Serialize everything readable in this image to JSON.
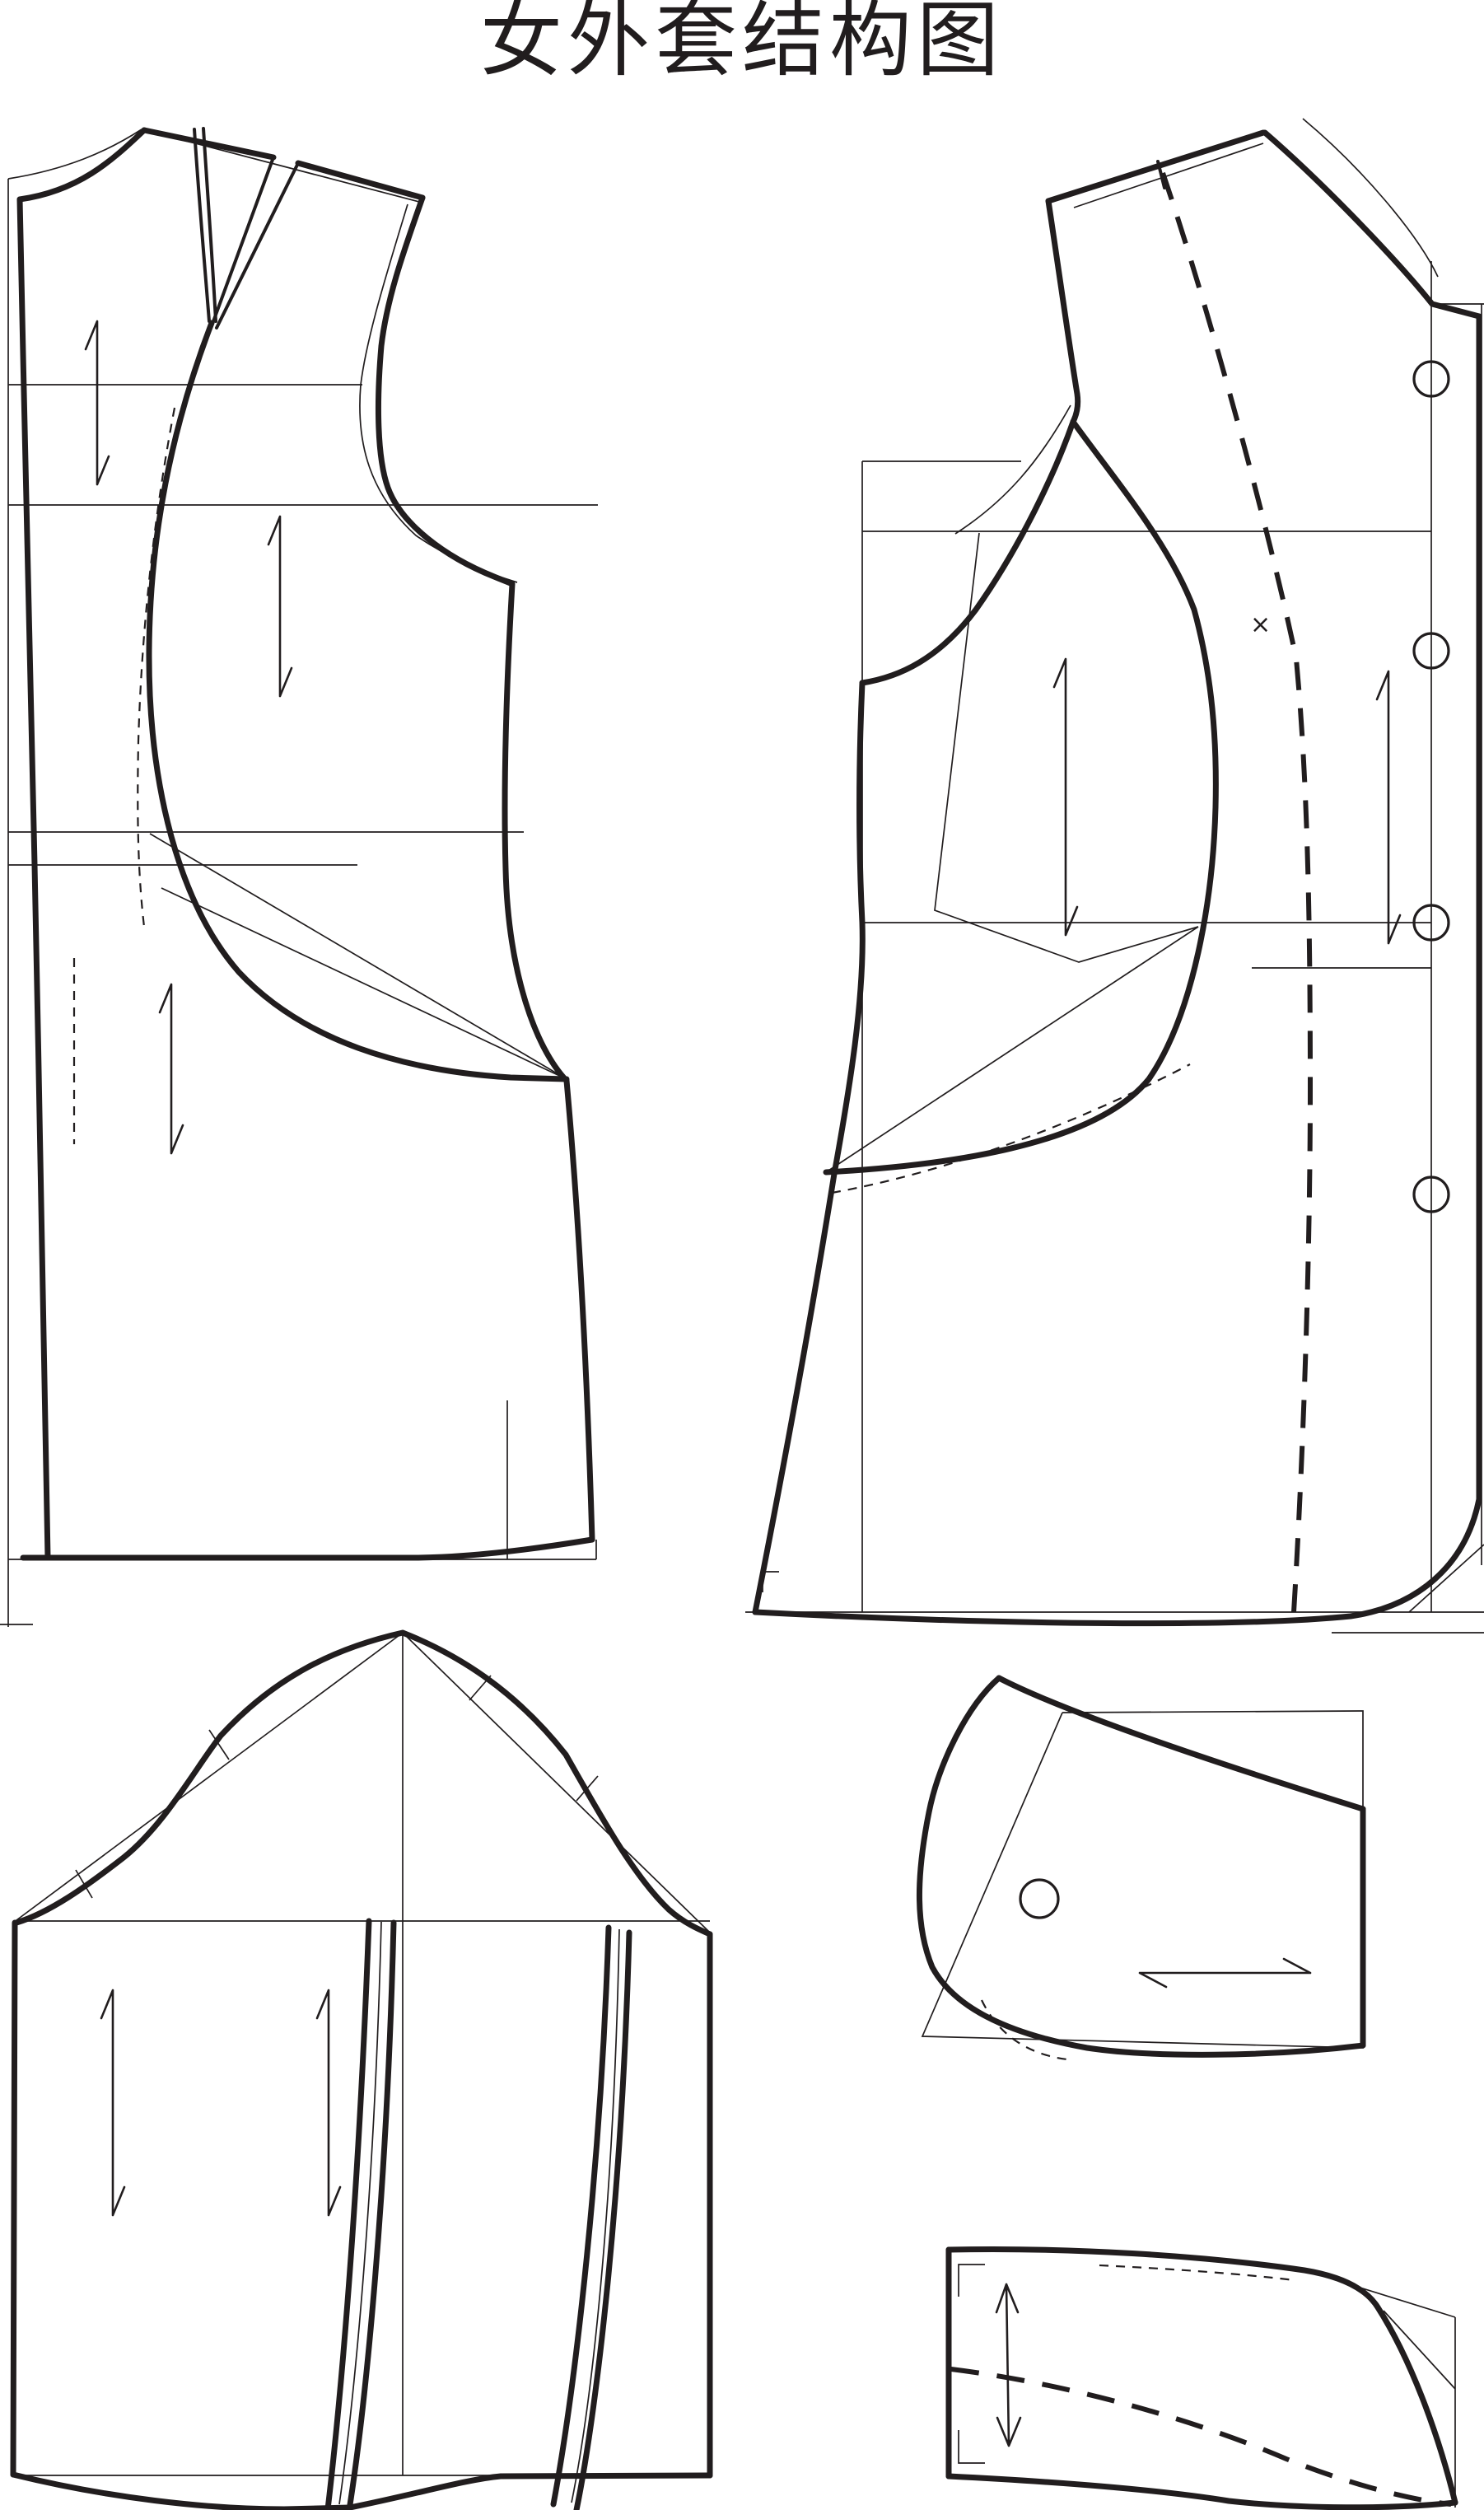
{
  "title": "女外套结构图",
  "marks": {
    "cross": "×"
  },
  "colors": {
    "background": "#ffffff",
    "ink": "#211d1e"
  }
}
